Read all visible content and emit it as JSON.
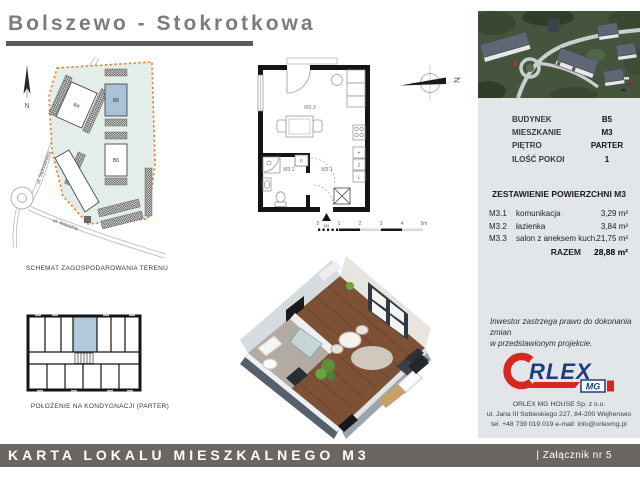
{
  "header": {
    "title": "Bolszewo - Stokrotkowa"
  },
  "site_plan": {
    "caption": "SCHEMAT ZAGOSPODAROWANIA TERENU",
    "streets": {
      "stokrotkowa": "ul. Stokrotkowa",
      "wspolna": "ul. Wspólna"
    },
    "buildings": {
      "b4": "B4",
      "b5": "B5",
      "b6": "B6"
    },
    "compass_label": "N"
  },
  "unit_plan": {
    "rooms": {
      "m31": "M3.1",
      "m32": "M3.2",
      "m33": "M3.3"
    },
    "entrance_label": "M3",
    "washer_label": "P",
    "appliances": {
      "plus": "+",
      "z": "Z",
      "l": "L"
    },
    "scale": {
      "t0": "0",
      "t1": "1",
      "t2": "2",
      "t3": "3",
      "t4": "4",
      "t5": "5m"
    },
    "compass_label": "N"
  },
  "floor_plan": {
    "caption": "POŁOŻENIE NA KONDYGNACJI (PARTER)"
  },
  "info_panel": {
    "rows": [
      {
        "label": "BUDYNEK",
        "value": "B5"
      },
      {
        "label": "MIESZKANIE",
        "value": "M3"
      },
      {
        "label": "PIĘTRO",
        "value": "PARTER"
      },
      {
        "label": "ILOŚĆ POKOI",
        "value": "1"
      }
    ],
    "area": {
      "title": "ZESTAWIENIE POWIERZCHNI M3",
      "rows": [
        {
          "code": "M3.1",
          "name": "komunikacja",
          "value": "3,29 m²"
        },
        {
          "code": "M3.2",
          "name": "łazienka",
          "value": "3,84 m²"
        },
        {
          "code": "M3.3",
          "name": "salon z aneksem kuch.",
          "value": "21,75 m²"
        }
      ],
      "total_label": "RAZEM",
      "total_value": "28,88 m²"
    },
    "disclaimer_line1": "Inwestor zastrzega prawo do dokonania zmian",
    "disclaimer_line2": "w przedstawionym projekcie.",
    "logo": {
      "main": "RLEX",
      "badge": "MG"
    },
    "company_name": "ORLEX MG HOUSE  Sp. z o.o.",
    "company_address": "ul.  Jana III Sobieskiego 227,  84-200 Wejherowo",
    "company_contact": "tel.  +48 739 019 019      e-mail: info@orlexmg.pl"
  },
  "footer": {
    "title": "KARTA LOKALU MIESZKALNEGO  M3",
    "attachment": "|  Załącznik nr 5"
  },
  "colors": {
    "accent_orange": "#f07a28",
    "highlight_blue": "#a9c2d6",
    "panel_bg": "#e2e6e9",
    "footer_bg": "#6b6662",
    "logo_navy": "#1d3e78",
    "logo_red": "#d6281e",
    "title_gray": "#7c7c7c"
  }
}
